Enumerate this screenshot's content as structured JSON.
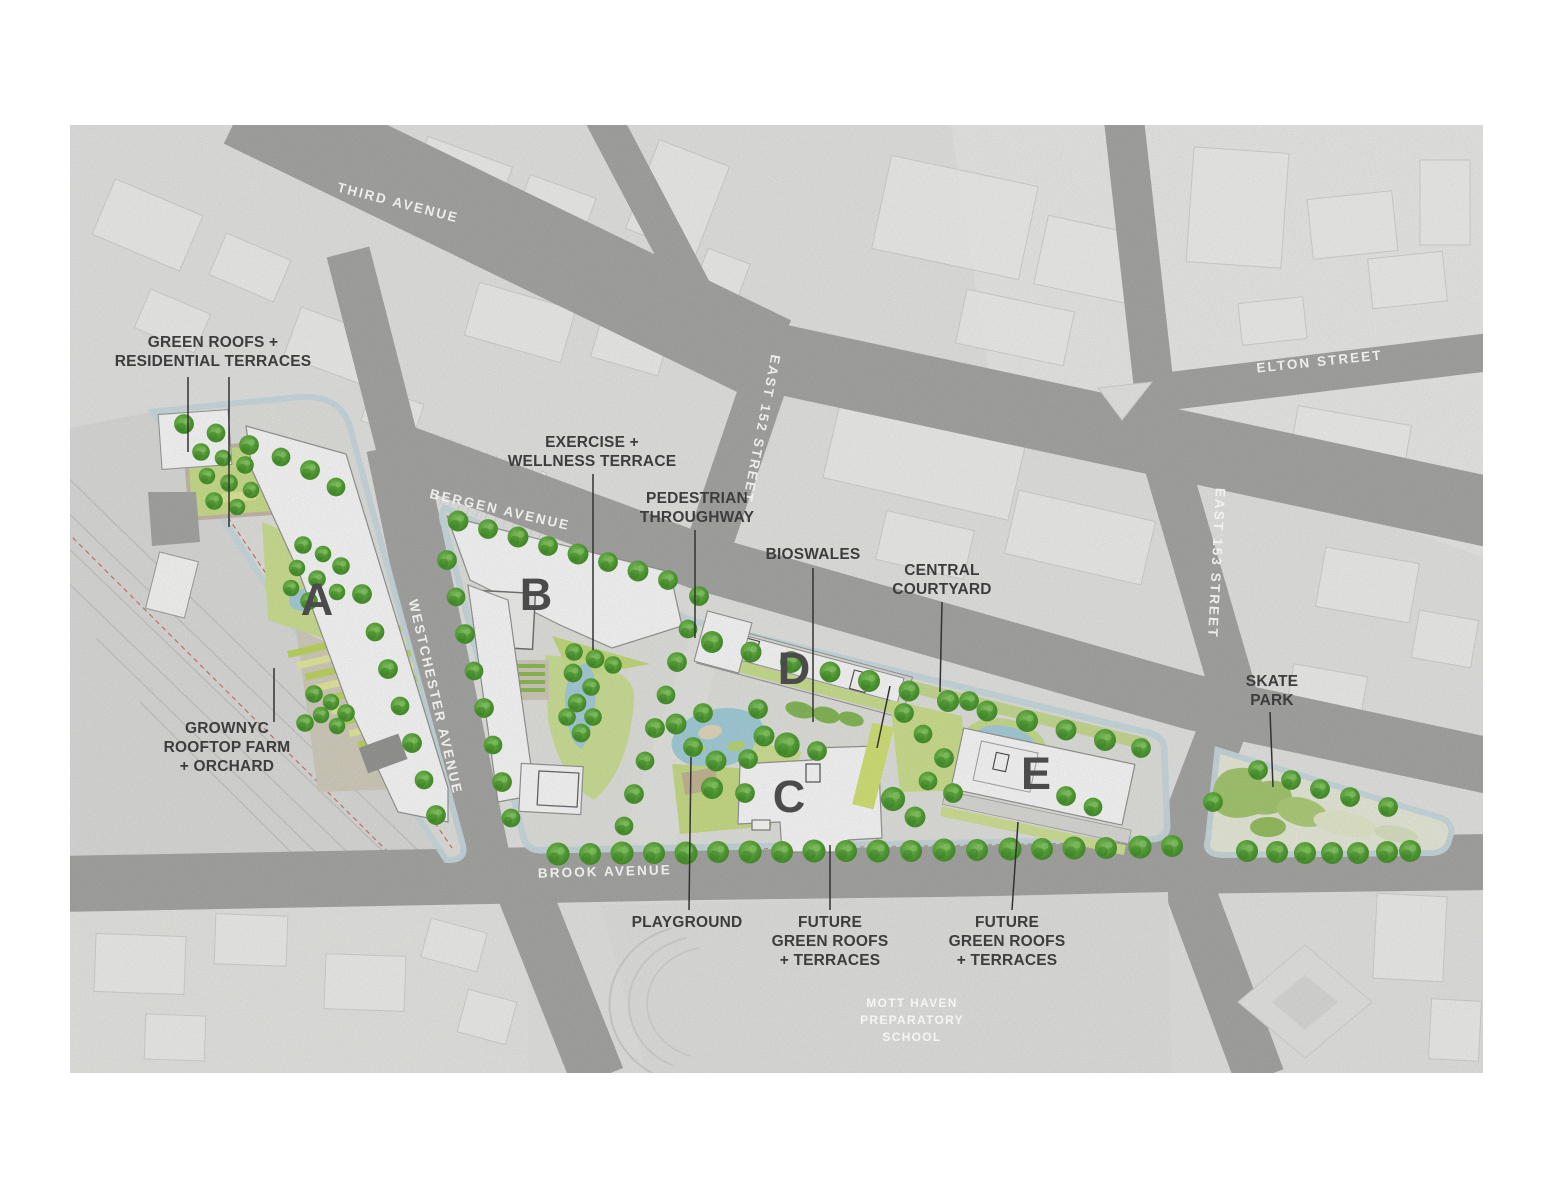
{
  "map": {
    "title": "Site plan aerial map",
    "streets": {
      "third_avenue": "THIRD AVENUE",
      "bergen_avenue": "BERGEN AVENUE",
      "westchester_avenue": "WESTCHESTER AVENUE",
      "brook_avenue": "BROOK AVENUE",
      "east_152_street": "EAST 152 STREET",
      "east_153_street": "EAST 153 STREET",
      "elton_street": "ELTON STREET"
    },
    "buildings": {
      "a": "A",
      "b": "B",
      "c": "C",
      "d": "D",
      "e": "E"
    },
    "annotations": {
      "green_roofs": [
        "GREEN ROOFS +",
        "RESIDENTIAL TERRACES"
      ],
      "exercise_terrace": [
        "EXERCISE +",
        "WELLNESS TERRACE"
      ],
      "pedestrian_throughway": [
        "PEDESTRIAN",
        "THROUGHWAY"
      ],
      "bioswales": [
        "BIOSWALES"
      ],
      "central_courtyard": [
        "CENTRAL",
        "COURTYARD"
      ],
      "grownyc_farm": [
        "GROWNYC",
        "ROOFTOP FARM",
        "+ ORCHARD"
      ],
      "playground": [
        "PLAYGROUND"
      ],
      "future_green_roofs_west": [
        "FUTURE",
        "GREEN ROOFS",
        "+ TERRACES"
      ],
      "future_green_roofs_east": [
        "FUTURE",
        "GREEN ROOFS",
        "+ TERRACES"
      ],
      "skate_park": [
        "SKATE",
        "PARK"
      ]
    },
    "places": {
      "mott_haven_school": [
        "MOTT HAVEN",
        "PREPARATORY",
        "SCHOOL"
      ]
    },
    "colors": {
      "background": "#ffffff",
      "block": "#eaeae9",
      "road": "#a9a9a8",
      "annotation_text": "#3d3d3d",
      "street_text": "#f4f4f2",
      "building_letter": "#4b4b4b",
      "building_fill": "#ffffff",
      "tree_green": "#55a336",
      "lawn_green": "#cee28e",
      "water_blue": "#abd3e0",
      "sidewalk_blue": "#cde0e5",
      "red_dash": "#d05a49"
    }
  }
}
